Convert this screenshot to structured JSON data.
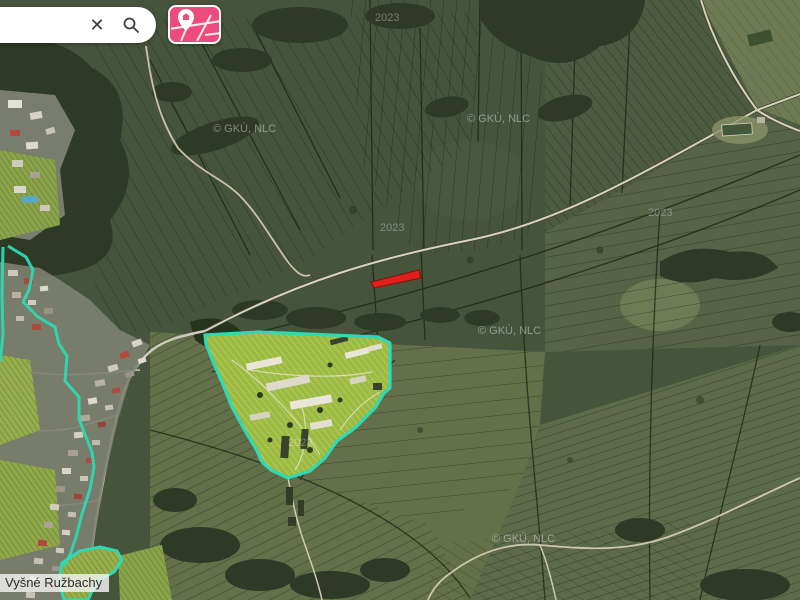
{
  "toolbar": {
    "search": {
      "value": "",
      "clear_icon": "✕"
    },
    "icons": {
      "clear": "close-icon",
      "search": "search-icon",
      "map_button": "map-pin-map-icon"
    },
    "map_button_color": "#ec4b7b"
  },
  "map": {
    "place_label": "Vyšné Ružbachy",
    "copyright_watermark": "© GKÚ, NLC",
    "year_watermark": "2023",
    "colors": {
      "selected_parcel_red": "#e01f1a",
      "boundary_highlight_cyan": "#2ed9b4",
      "area_highlight_green": "#9dbb43"
    }
  }
}
